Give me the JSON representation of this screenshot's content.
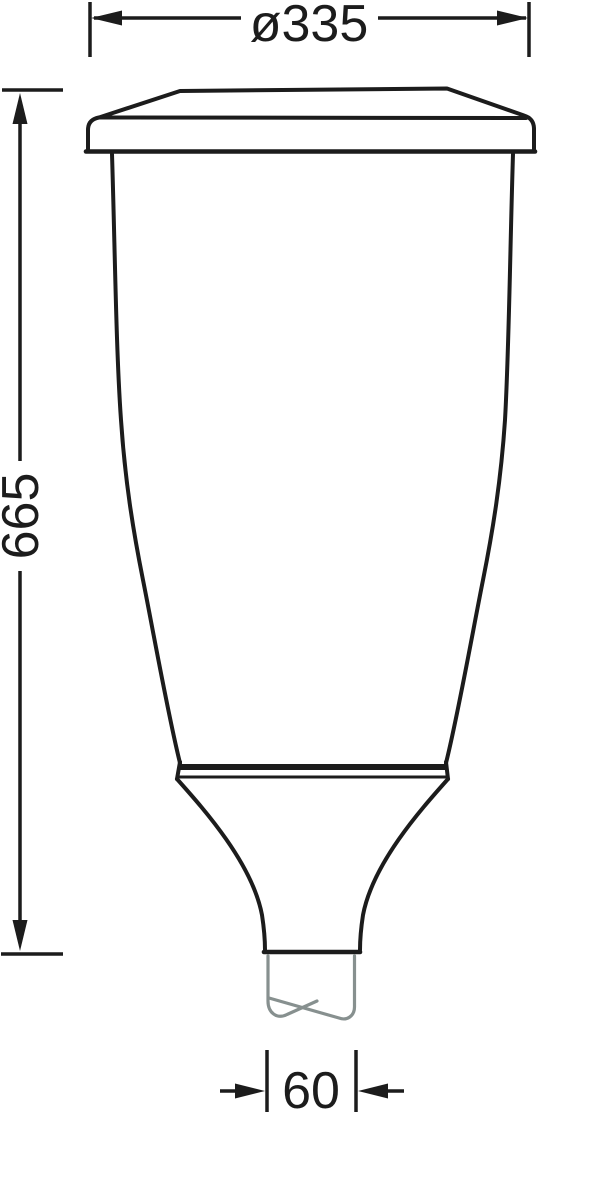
{
  "drawing": {
    "kind": "technical dimension drawing",
    "subject": "post-top luminaire body on pole spigot (front elevation)",
    "colors": {
      "line": "#1c1c1c",
      "pole_break": "#87908f",
      "background": "#ffffff"
    },
    "dimensions": {
      "diameter": {
        "label": "ø335",
        "value": 335,
        "placement": "top horizontal"
      },
      "height": {
        "label": "665",
        "value": 665,
        "placement": "left vertical, text rotated"
      },
      "spigot": {
        "label": "60",
        "value": 60,
        "placement": "bottom horizontal, outside arrows"
      }
    }
  }
}
